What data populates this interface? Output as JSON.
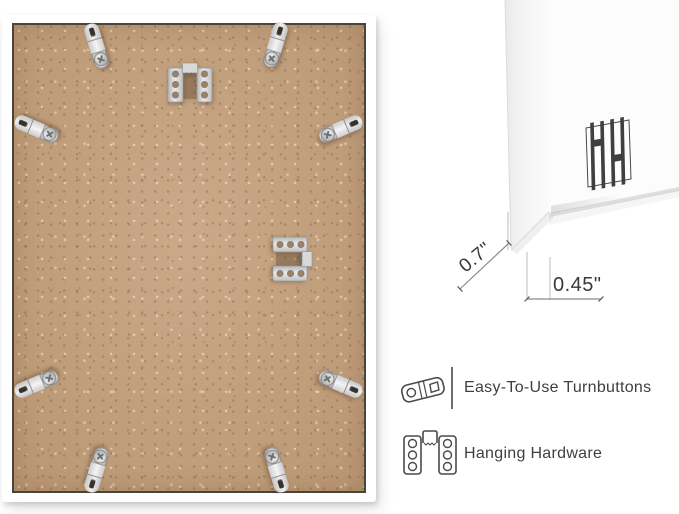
{
  "product_photo": {
    "description": "Back view of white picture frame with MDF backing board",
    "frame_color": "#ffffff",
    "board_color": "#c4a07c",
    "board_border_color": "#4b443a",
    "hardware_color": "#d9d9d9",
    "turnbuttons": [
      {
        "x": 96,
        "y": 46,
        "rot": -17
      },
      {
        "x": 275,
        "y": 45,
        "rot": 17
      },
      {
        "x": 36,
        "y": 129,
        "rot": -67
      },
      {
        "x": 340,
        "y": 129,
        "rot": 67
      },
      {
        "x": 36,
        "y": 384,
        "rot": -113
      },
      {
        "x": 340,
        "y": 384,
        "rot": 113
      },
      {
        "x": 96,
        "y": 470,
        "rot": 197
      },
      {
        "x": 276,
        "y": 470,
        "rot": 163
      }
    ],
    "hangers": [
      {
        "x": 190,
        "y": 84,
        "rot": 0
      },
      {
        "x": 291,
        "y": 259,
        "rot": 90
      }
    ]
  },
  "corner_detail": {
    "depth_label": "0.7\"",
    "face_label": "0.45\"",
    "brand_mark": "HH"
  },
  "features": [
    {
      "icon": "turnbutton-icon",
      "label": "Easy-To-Use Turnbuttons"
    },
    {
      "icon": "hanging-hardware-icon",
      "label": "Hanging Hardware"
    }
  ]
}
